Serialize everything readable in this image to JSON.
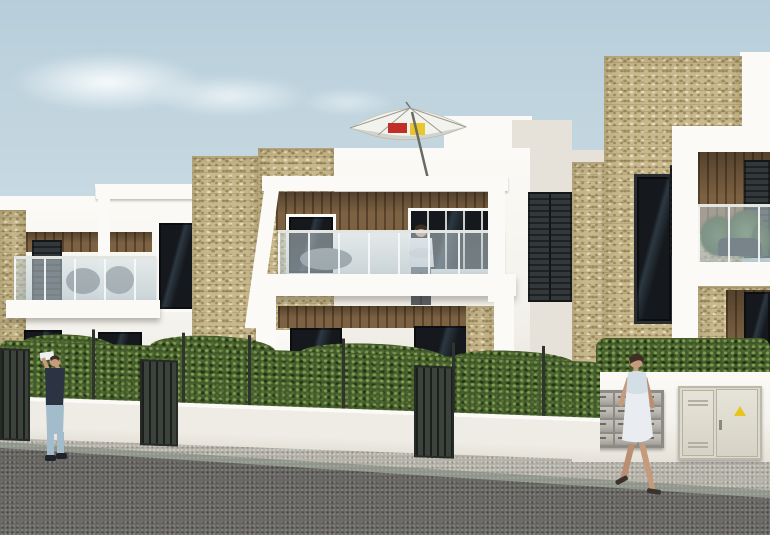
{
  "meta": {
    "title": "Street view architectural render of new-build two-storey apartments",
    "domain_note": "photoreal 3D visualisation, no legible UI text"
  },
  "colors": {
    "sky_top": "#b7ceda",
    "sky_mid": "#cbdce4",
    "sky_horizon": "#e3ecef",
    "cloud_white": "#f2f6f7",
    "wall_white": "#f4f2ec",
    "wall_bright": "#fbfaf6",
    "wall_shade": "#e6e2d9",
    "wall_shadow": "#d3cfc5",
    "stone_base": "#c8b88c",
    "stone_fleck_dark": "#8a7a4e",
    "stone_fleck_light": "#ece2bd",
    "wood_base": "#7c6142",
    "wood_dark": "#54412c",
    "window_dark": "#15181c",
    "window_reflect": "#2c3842",
    "shutter_dark": "#33383b",
    "glass_tint": "#c2d3da",
    "railing_metal": "#e3e5e1",
    "hedge_green": "#42592c",
    "hedge_light": "#8aa455",
    "hedge_dark": "#1f3314",
    "garden_wall": "#eeece5",
    "fence_metal": "#30342f",
    "sidewalk_gray": "#b4b1a8",
    "curb_gray": "#8f958a",
    "road_asphalt": "#5d5c58",
    "mailbox_metal": "#b5b2ab",
    "cabinet_cream": "#ddd9cd",
    "warning_yellow": "#e7c41f",
    "parasol_white": "#f3f3ee",
    "parasol_red": "#c03028",
    "parasol_yellow": "#e8c62e",
    "skin": "#c69a7c",
    "hair_dark": "#3c2f24",
    "man_shirt_navy": "#2c3342",
    "man_jeans": "#a3bccb",
    "tee_white": "#edeff0",
    "pants_gray": "#595e64",
    "woman_dress": "#e9edf1"
  },
  "scene": {
    "sky": {
      "clouds": 3
    },
    "buildings": [
      {
        "id": "left-block",
        "storeys": 2,
        "features": [
          "white pergola frame",
          "glass balcony",
          "dark shutters",
          "stone accent strip",
          "wood slat soffit"
        ]
      },
      {
        "id": "middle-block",
        "storeys": 2,
        "features": [
          "roof terrace with parasol",
          "white pergola frame",
          "wood slat soffit",
          "glass balcony with resident",
          "ground floor terraces"
        ]
      },
      {
        "id": "right-block",
        "storeys": 2,
        "features": [
          "tall sandstone feature tower",
          "open dark shutters",
          "planted glass balcony",
          "wood cladding"
        ]
      }
    ],
    "stone_towers": 3,
    "parasol": {
      "canopy": "white",
      "label_left_color": "#c03028",
      "label_right_color": "#e8c62e",
      "tilted_mast": true
    },
    "street": {
      "hedge": {
        "continuous": true,
        "behind_low_white_wall": true
      },
      "fence": {
        "posts_x": [
          92,
          182,
          248,
          342,
          452,
          542
        ],
        "gates": 3
      },
      "utility_wall": {
        "mailboxes": {
          "rows": 4,
          "cols": 3
        },
        "cabinet": {
          "doors": 2,
          "vents": 2,
          "warning_triangle": true,
          "handle": true
        }
      },
      "sidewalk": "grey paved, sloping toward right foreground",
      "road": "dark asphalt foreground"
    },
    "people": [
      {
        "id": "photographer",
        "where": "left sidewalk",
        "clothes": [
          "navy t-shirt",
          "light blue jeans"
        ],
        "pose": "arms raised taking photo"
      },
      {
        "id": "balcony-resident",
        "where": "middle first-floor balcony",
        "clothes": [
          "white t-shirt",
          "grey trousers"
        ],
        "pose": "leaning on railing"
      },
      {
        "id": "walking-woman",
        "where": "right sidewalk",
        "clothes": [
          "white summer dress",
          "heeled sandals"
        ],
        "pose": "walking right"
      }
    ]
  }
}
